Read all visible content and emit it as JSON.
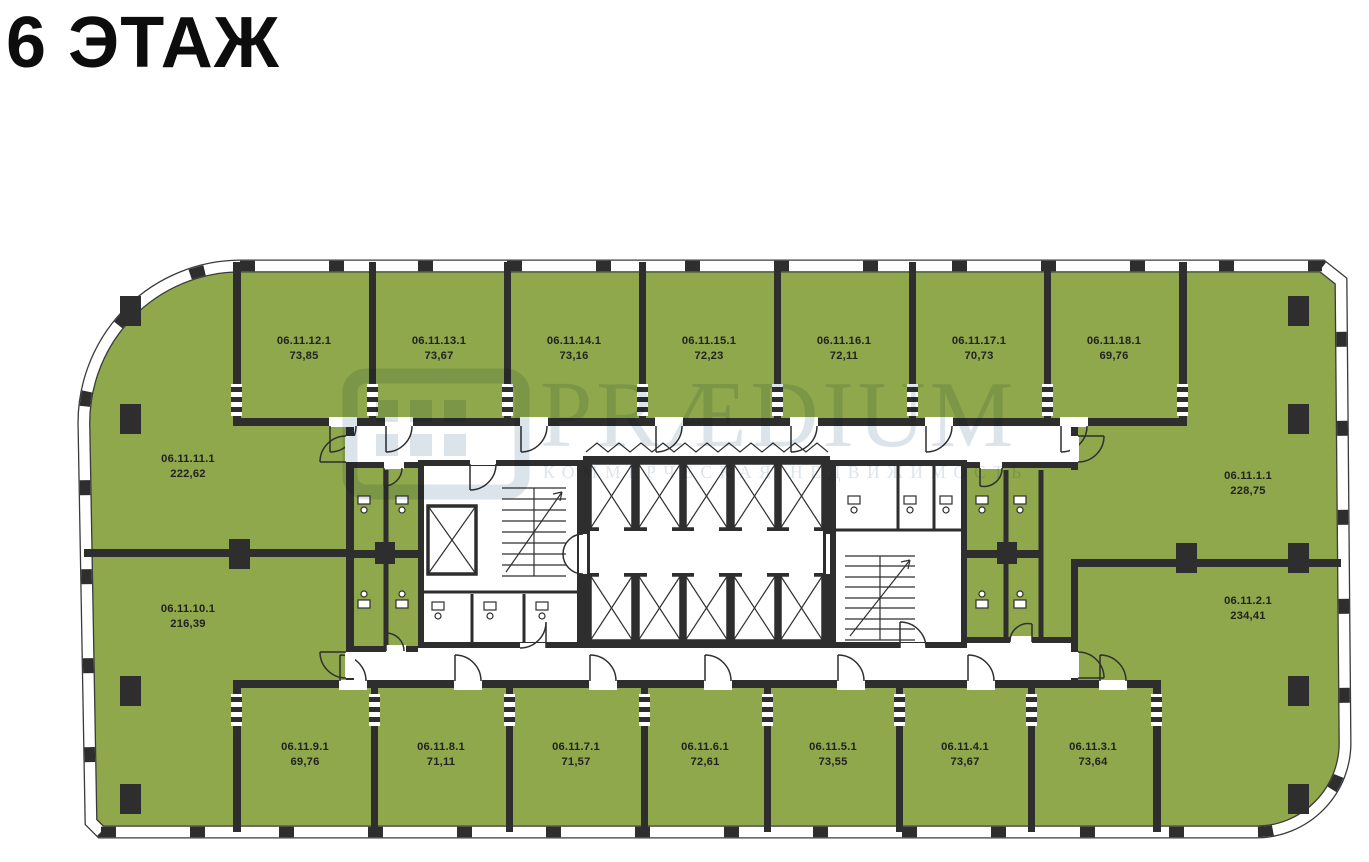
{
  "title": "6 ЭТАЖ",
  "watermark": {
    "brand": "PRÆDIUM",
    "subtitle": "КОММЕРЧЕСКАЯ НЕДВИЖИМОСТЬ"
  },
  "colors": {
    "room_green": "#8FA84C",
    "wall_dark": "#2E2E2E",
    "watermark_blue": "#B9C9D8",
    "corridor_white": "#FFFFFF",
    "title_black": "#0D0D0D"
  },
  "rooms": {
    "top_row": [
      {
        "id": "06.11.12.1",
        "area": "73,85"
      },
      {
        "id": "06.11.13.1",
        "area": "73,67"
      },
      {
        "id": "06.11.14.1",
        "area": "73,16"
      },
      {
        "id": "06.11.15.1",
        "area": "72,23"
      },
      {
        "id": "06.11.16.1",
        "area": "72,11"
      },
      {
        "id": "06.11.17.1",
        "area": "70,73"
      },
      {
        "id": "06.11.18.1",
        "area": "69,76"
      }
    ],
    "left_column": [
      {
        "id": "06.11.11.1",
        "area": "222,62"
      },
      {
        "id": "06.11.10.1",
        "area": "216,39"
      }
    ],
    "right_column": [
      {
        "id": "06.11.1.1",
        "area": "228,75"
      },
      {
        "id": "06.11.2.1",
        "area": "234,41"
      }
    ],
    "bottom_row": [
      {
        "id": "06.11.9.1",
        "area": "69,76"
      },
      {
        "id": "06.11.8.1",
        "area": "71,11"
      },
      {
        "id": "06.11.7.1",
        "area": "71,57"
      },
      {
        "id": "06.11.6.1",
        "area": "72,61"
      },
      {
        "id": "06.11.5.1",
        "area": "73,55"
      },
      {
        "id": "06.11.4.1",
        "area": "73,67"
      },
      {
        "id": "06.11.3.1",
        "area": "73,64"
      }
    ]
  }
}
